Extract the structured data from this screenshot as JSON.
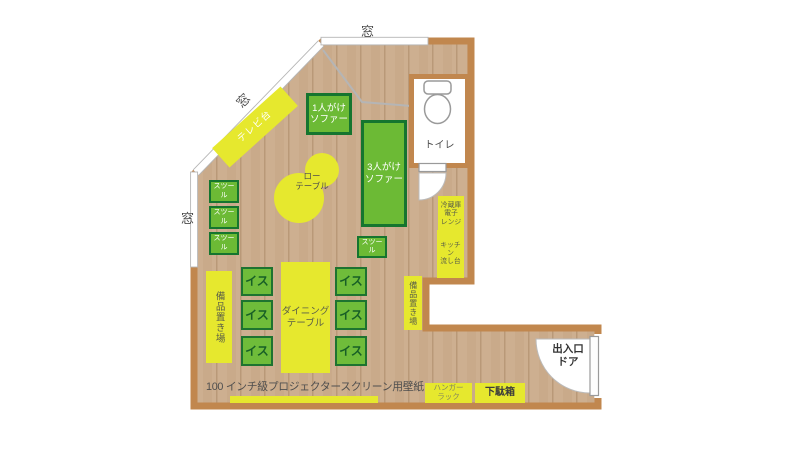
{
  "labels": {
    "toilet": "トイレ",
    "entrance_door": "出入口\nドア",
    "projector_note": "100 インチ級プロジェクタースクリーン用壁紙"
  },
  "windows": [
    "窓",
    "窓",
    "窓"
  ],
  "furniture": {
    "tv_stand": "テレビ台",
    "sofa_1seat": "1人がけ\nソファー",
    "sofa_3seat": "3人がけ\nソファー",
    "low_table": "ロー\nテーブル",
    "stools": [
      "スツール",
      "スツール",
      "スツール",
      "スツール"
    ],
    "fridge_microwave": "冷蔵庫\n電子\nレンジ",
    "kitchen_sink": "キッチン\n流し台",
    "storage_areas": [
      "備品置き場",
      "備品置き場"
    ],
    "chairs": [
      "イス",
      "イス",
      "イス",
      "イス",
      "イス",
      "イス"
    ],
    "dining_table": "ダイニング\nテーブル",
    "hanger_rack": "ハンガー\nラック",
    "shoe_box": "下駄箱"
  },
  "colors": {
    "wall": "#c1874e",
    "floor": "#cdaf90",
    "furniture_green": "#6cba35",
    "furniture_green_border": "#15752f",
    "furniture_yellow": "#e6e82e"
  }
}
